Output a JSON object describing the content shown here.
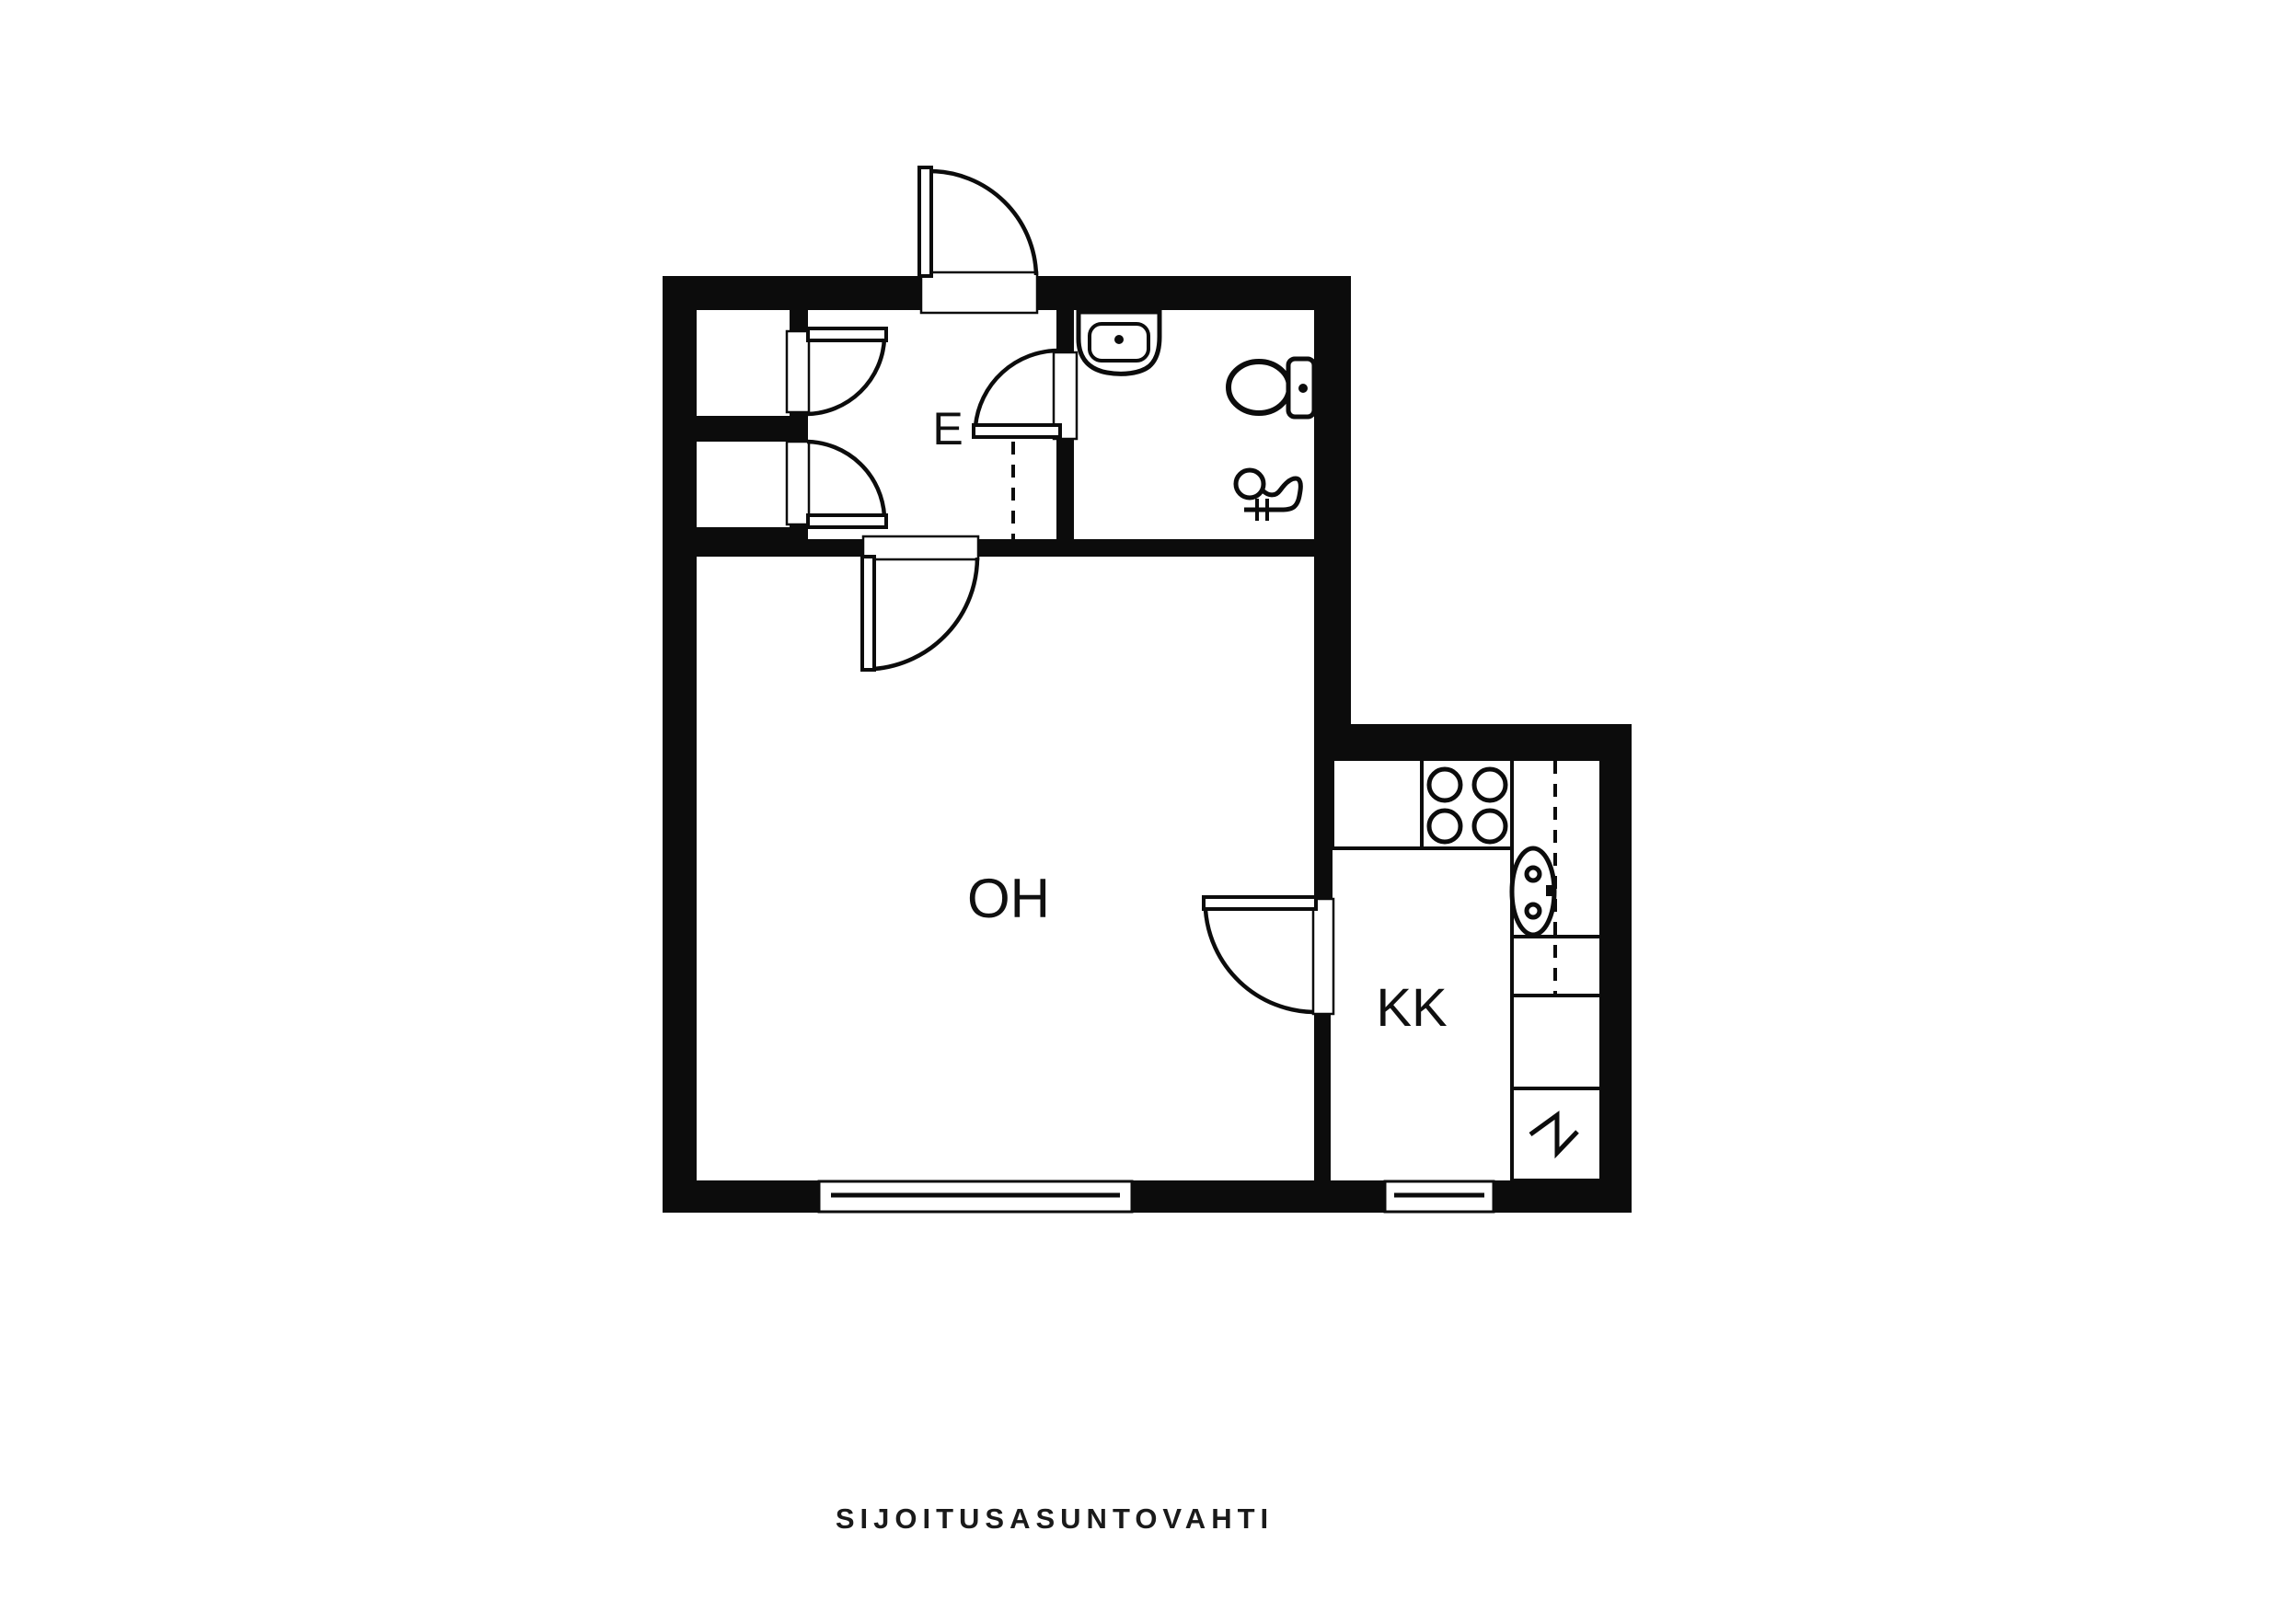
{
  "page": {
    "background": "#ffffff",
    "line_color": "#0c0c0c"
  },
  "floor_plan": {
    "rooms": [
      {
        "id": "hallway",
        "label": "E"
      },
      {
        "id": "living_room",
        "label": "OH"
      },
      {
        "id": "kitchenette",
        "label": "KK"
      }
    ],
    "fixtures": {
      "bathroom": [
        "sink",
        "toilet",
        "floor-drain"
      ],
      "kitchen": [
        "stove-burners",
        "sink",
        "counter",
        "appliance-reservation-zigzag"
      ],
      "hallway": [
        "closet-top",
        "closet-bottom"
      ]
    },
    "doors": [
      "entry-door",
      "closet-top-door",
      "closet-bottom-door",
      "bathroom-door",
      "hallway-living-room-door",
      "living-room-kitchenette-door"
    ],
    "windows": [
      "living-room-window",
      "kitchenette-window"
    ]
  },
  "footer": {
    "brand": "SIJOITUSASUNTOVAHTI"
  }
}
